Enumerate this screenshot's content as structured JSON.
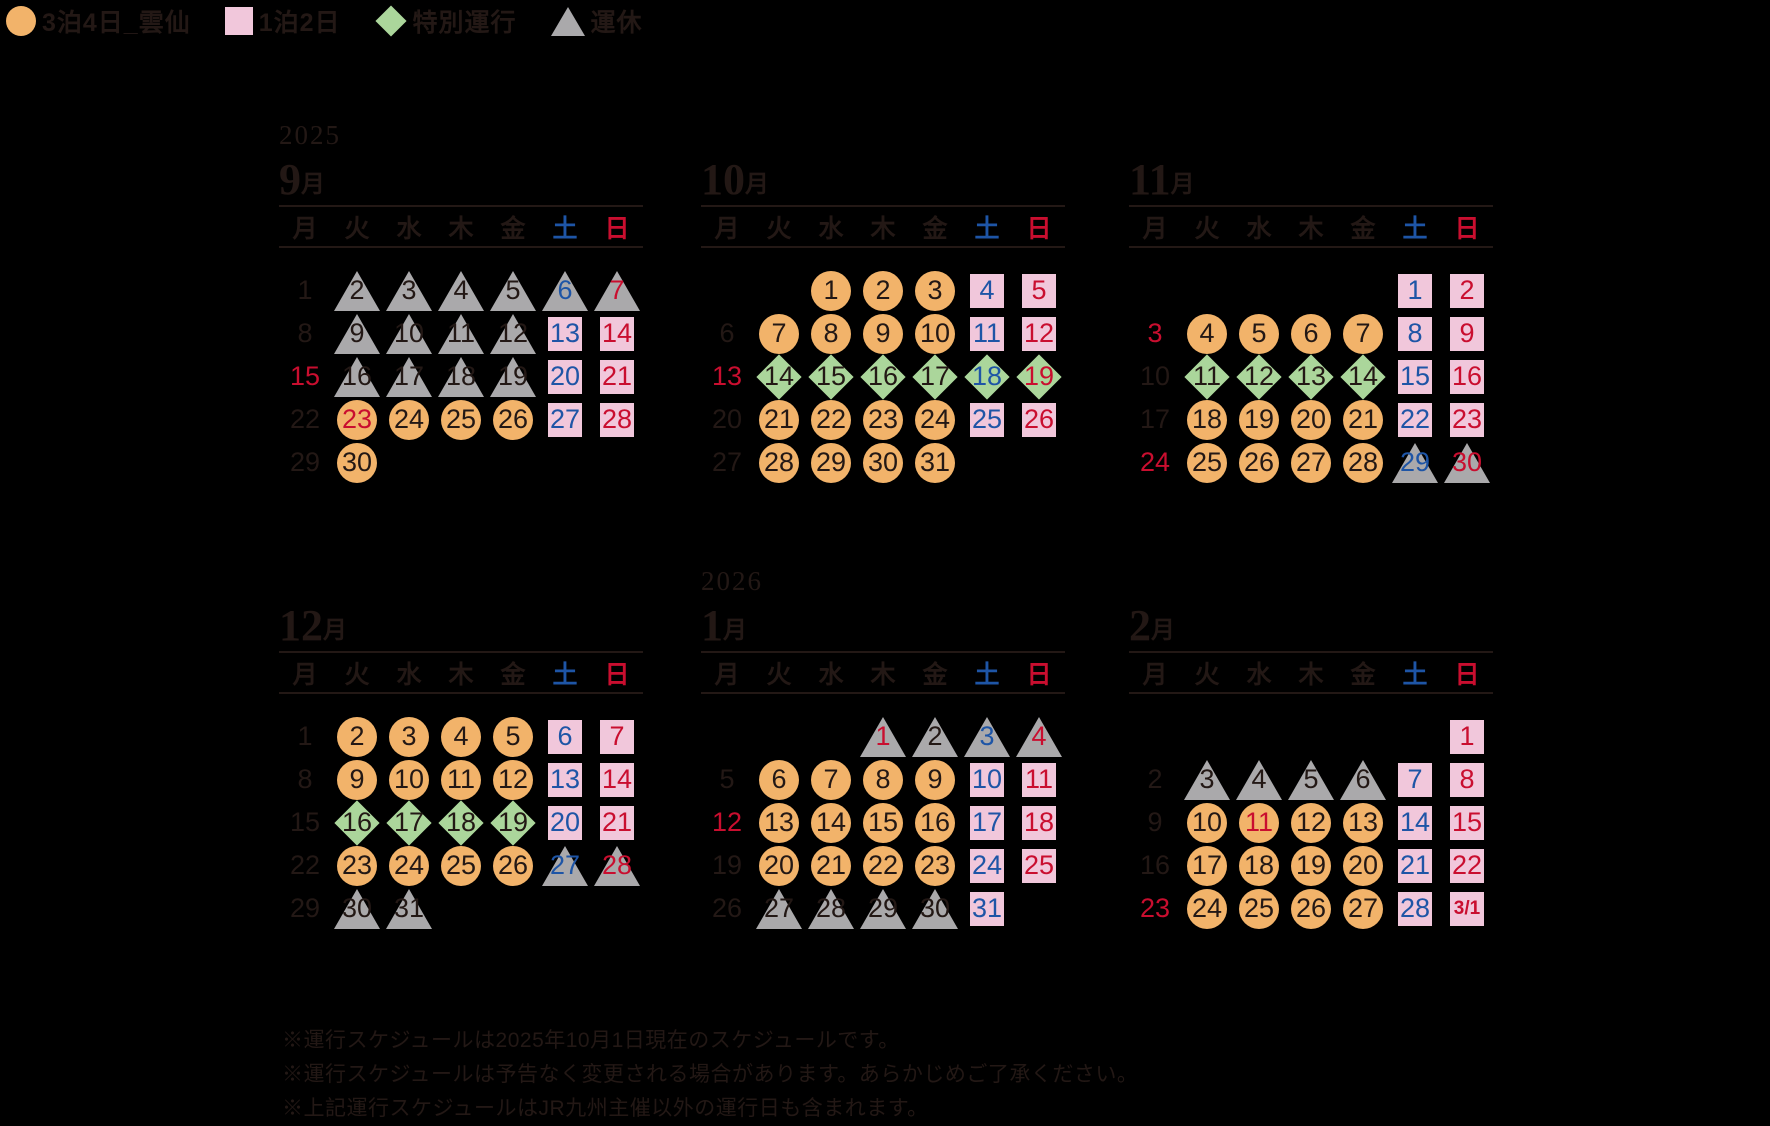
{
  "legend": {
    "items": [
      {
        "icon": "circle-icon",
        "shape": "circle",
        "label": "3泊4日_雲仙"
      },
      {
        "icon": "square-icon",
        "shape": "square",
        "label": "1泊2日"
      },
      {
        "icon": "diamond-icon",
        "shape": "diamond",
        "label": "特別運行"
      },
      {
        "icon": "triangle-icon",
        "shape": "triangle",
        "label": "運休"
      }
    ]
  },
  "colors": {
    "dark": "#231815",
    "saturday_blue": "#1e55a6",
    "sunday_red": "#c90e2f",
    "circle_orange": "#f2b36a",
    "square_pink": "#f1c7db",
    "diamond_green": "#abd69b",
    "triangle_gray": "#aaa9ab"
  },
  "weekdays": [
    {
      "label": "月",
      "color": "dark"
    },
    {
      "label": "火",
      "color": "dark"
    },
    {
      "label": "水",
      "color": "dark"
    },
    {
      "label": "木",
      "color": "dark"
    },
    {
      "label": "金",
      "color": "dark"
    },
    {
      "label": "土",
      "color": "blue"
    },
    {
      "label": "日",
      "color": "red"
    }
  ],
  "months": [
    {
      "year": "2025",
      "num": "9",
      "suffix": "月",
      "weeks": [
        [
          {
            "d": "1"
          },
          {
            "d": "2",
            "b": "triangle"
          },
          {
            "d": "3",
            "b": "triangle"
          },
          {
            "d": "4",
            "b": "triangle"
          },
          {
            "d": "5",
            "b": "triangle"
          },
          {
            "d": "6",
            "b": "triangle",
            "c": "blue"
          },
          {
            "d": "7",
            "b": "triangle",
            "c": "red"
          }
        ],
        [
          {
            "d": "8"
          },
          {
            "d": "9",
            "b": "triangle"
          },
          {
            "d": "10",
            "b": "triangle"
          },
          {
            "d": "11",
            "b": "triangle"
          },
          {
            "d": "12",
            "b": "triangle"
          },
          {
            "d": "13",
            "b": "square",
            "c": "blue"
          },
          {
            "d": "14",
            "b": "square",
            "c": "red"
          }
        ],
        [
          {
            "d": "15",
            "c": "red"
          },
          {
            "d": "16",
            "b": "triangle"
          },
          {
            "d": "17",
            "b": "triangle"
          },
          {
            "d": "18",
            "b": "triangle"
          },
          {
            "d": "19",
            "b": "triangle"
          },
          {
            "d": "20",
            "b": "square",
            "c": "blue"
          },
          {
            "d": "21",
            "b": "square",
            "c": "red"
          }
        ],
        [
          {
            "d": "22"
          },
          {
            "d": "23",
            "b": "circle",
            "c": "red"
          },
          {
            "d": "24",
            "b": "circle"
          },
          {
            "d": "25",
            "b": "circle"
          },
          {
            "d": "26",
            "b": "circle"
          },
          {
            "d": "27",
            "b": "square",
            "c": "blue"
          },
          {
            "d": "28",
            "b": "square",
            "c": "red"
          }
        ],
        [
          {
            "d": "29"
          },
          {
            "d": "30",
            "b": "circle"
          },
          null,
          null,
          null,
          null,
          null
        ]
      ]
    },
    {
      "year": "",
      "num": "10",
      "suffix": "月",
      "weeks": [
        [
          null,
          null,
          {
            "d": "1",
            "b": "circle"
          },
          {
            "d": "2",
            "b": "circle"
          },
          {
            "d": "3",
            "b": "circle"
          },
          {
            "d": "4",
            "b": "square",
            "c": "blue"
          },
          {
            "d": "5",
            "b": "square",
            "c": "red"
          }
        ],
        [
          {
            "d": "6"
          },
          {
            "d": "7",
            "b": "circle"
          },
          {
            "d": "8",
            "b": "circle"
          },
          {
            "d": "9",
            "b": "circle"
          },
          {
            "d": "10",
            "b": "circle"
          },
          {
            "d": "11",
            "b": "square",
            "c": "blue"
          },
          {
            "d": "12",
            "b": "square",
            "c": "red"
          }
        ],
        [
          {
            "d": "13",
            "c": "red"
          },
          {
            "d": "14",
            "b": "diamond"
          },
          {
            "d": "15",
            "b": "diamond"
          },
          {
            "d": "16",
            "b": "diamond"
          },
          {
            "d": "17",
            "b": "diamond"
          },
          {
            "d": "18",
            "b": "diamond",
            "c": "blue"
          },
          {
            "d": "19",
            "b": "diamond",
            "c": "red"
          }
        ],
        [
          {
            "d": "20"
          },
          {
            "d": "21",
            "b": "circle"
          },
          {
            "d": "22",
            "b": "circle"
          },
          {
            "d": "23",
            "b": "circle"
          },
          {
            "d": "24",
            "b": "circle"
          },
          {
            "d": "25",
            "b": "square",
            "c": "blue"
          },
          {
            "d": "26",
            "b": "square",
            "c": "red"
          }
        ],
        [
          {
            "d": "27"
          },
          {
            "d": "28",
            "b": "circle"
          },
          {
            "d": "29",
            "b": "circle"
          },
          {
            "d": "30",
            "b": "circle"
          },
          {
            "d": "31",
            "b": "circle"
          },
          null,
          null
        ]
      ]
    },
    {
      "year": "",
      "num": "11",
      "suffix": "月",
      "weeks": [
        [
          null,
          null,
          null,
          null,
          null,
          {
            "d": "1",
            "b": "square",
            "c": "blue"
          },
          {
            "d": "2",
            "b": "square",
            "c": "red"
          }
        ],
        [
          {
            "d": "3",
            "c": "red"
          },
          {
            "d": "4",
            "b": "circle"
          },
          {
            "d": "5",
            "b": "circle"
          },
          {
            "d": "6",
            "b": "circle"
          },
          {
            "d": "7",
            "b": "circle"
          },
          {
            "d": "8",
            "b": "square",
            "c": "blue"
          },
          {
            "d": "9",
            "b": "square",
            "c": "red"
          }
        ],
        [
          {
            "d": "10"
          },
          {
            "d": "11",
            "b": "diamond"
          },
          {
            "d": "12",
            "b": "diamond"
          },
          {
            "d": "13",
            "b": "diamond"
          },
          {
            "d": "14",
            "b": "diamond"
          },
          {
            "d": "15",
            "b": "square",
            "c": "blue"
          },
          {
            "d": "16",
            "b": "square",
            "c": "red"
          }
        ],
        [
          {
            "d": "17"
          },
          {
            "d": "18",
            "b": "circle"
          },
          {
            "d": "19",
            "b": "circle"
          },
          {
            "d": "20",
            "b": "circle"
          },
          {
            "d": "21",
            "b": "circle"
          },
          {
            "d": "22",
            "b": "square",
            "c": "blue"
          },
          {
            "d": "23",
            "b": "square",
            "c": "red"
          }
        ],
        [
          {
            "d": "24",
            "c": "red"
          },
          {
            "d": "25",
            "b": "circle"
          },
          {
            "d": "26",
            "b": "circle"
          },
          {
            "d": "27",
            "b": "circle"
          },
          {
            "d": "28",
            "b": "circle"
          },
          {
            "d": "29",
            "b": "triangle",
            "c": "blue"
          },
          {
            "d": "30",
            "b": "triangle",
            "c": "red"
          }
        ]
      ]
    },
    {
      "year": "",
      "num": "12",
      "suffix": "月",
      "weeks": [
        [
          {
            "d": "1"
          },
          {
            "d": "2",
            "b": "circle"
          },
          {
            "d": "3",
            "b": "circle"
          },
          {
            "d": "4",
            "b": "circle"
          },
          {
            "d": "5",
            "b": "circle"
          },
          {
            "d": "6",
            "b": "square",
            "c": "blue"
          },
          {
            "d": "7",
            "b": "square",
            "c": "red"
          }
        ],
        [
          {
            "d": "8"
          },
          {
            "d": "9",
            "b": "circle"
          },
          {
            "d": "10",
            "b": "circle"
          },
          {
            "d": "11",
            "b": "circle"
          },
          {
            "d": "12",
            "b": "circle"
          },
          {
            "d": "13",
            "b": "square",
            "c": "blue"
          },
          {
            "d": "14",
            "b": "square",
            "c": "red"
          }
        ],
        [
          {
            "d": "15"
          },
          {
            "d": "16",
            "b": "diamond"
          },
          {
            "d": "17",
            "b": "diamond"
          },
          {
            "d": "18",
            "b": "diamond"
          },
          {
            "d": "19",
            "b": "diamond"
          },
          {
            "d": "20",
            "b": "square",
            "c": "blue"
          },
          {
            "d": "21",
            "b": "square",
            "c": "red"
          }
        ],
        [
          {
            "d": "22"
          },
          {
            "d": "23",
            "b": "circle"
          },
          {
            "d": "24",
            "b": "circle"
          },
          {
            "d": "25",
            "b": "circle"
          },
          {
            "d": "26",
            "b": "circle"
          },
          {
            "d": "27",
            "b": "triangle",
            "c": "blue"
          },
          {
            "d": "28",
            "b": "triangle",
            "c": "red"
          }
        ],
        [
          {
            "d": "29"
          },
          {
            "d": "30",
            "b": "triangle"
          },
          {
            "d": "31",
            "b": "triangle"
          },
          null,
          null,
          null,
          null
        ]
      ]
    },
    {
      "year": "2026",
      "num": "1",
      "suffix": "月",
      "weeks": [
        [
          null,
          null,
          null,
          {
            "d": "1",
            "b": "triangle",
            "c": "red"
          },
          {
            "d": "2",
            "b": "triangle"
          },
          {
            "d": "3",
            "b": "triangle",
            "c": "blue"
          },
          {
            "d": "4",
            "b": "triangle",
            "c": "red"
          }
        ],
        [
          {
            "d": "5"
          },
          {
            "d": "6",
            "b": "circle"
          },
          {
            "d": "7",
            "b": "circle"
          },
          {
            "d": "8",
            "b": "circle"
          },
          {
            "d": "9",
            "b": "circle"
          },
          {
            "d": "10",
            "b": "square",
            "c": "blue"
          },
          {
            "d": "11",
            "b": "square",
            "c": "red"
          }
        ],
        [
          {
            "d": "12",
            "c": "red"
          },
          {
            "d": "13",
            "b": "circle"
          },
          {
            "d": "14",
            "b": "circle"
          },
          {
            "d": "15",
            "b": "circle"
          },
          {
            "d": "16",
            "b": "circle"
          },
          {
            "d": "17",
            "b": "square",
            "c": "blue"
          },
          {
            "d": "18",
            "b": "square",
            "c": "red"
          }
        ],
        [
          {
            "d": "19"
          },
          {
            "d": "20",
            "b": "circle"
          },
          {
            "d": "21",
            "b": "circle"
          },
          {
            "d": "22",
            "b": "circle"
          },
          {
            "d": "23",
            "b": "circle"
          },
          {
            "d": "24",
            "b": "square",
            "c": "blue"
          },
          {
            "d": "25",
            "b": "square",
            "c": "red"
          }
        ],
        [
          {
            "d": "26"
          },
          {
            "d": "27",
            "b": "triangle"
          },
          {
            "d": "28",
            "b": "triangle"
          },
          {
            "d": "29",
            "b": "triangle"
          },
          {
            "d": "30",
            "b": "triangle"
          },
          {
            "d": "31",
            "b": "square",
            "c": "blue"
          },
          null
        ]
      ]
    },
    {
      "year": "",
      "num": "2",
      "suffix": "月",
      "weeks": [
        [
          null,
          null,
          null,
          null,
          null,
          null,
          {
            "d": "1",
            "b": "square",
            "c": "red"
          }
        ],
        [
          {
            "d": "2"
          },
          {
            "d": "3",
            "b": "triangle"
          },
          {
            "d": "4",
            "b": "triangle"
          },
          {
            "d": "5",
            "b": "triangle"
          },
          {
            "d": "6",
            "b": "triangle"
          },
          {
            "d": "7",
            "b": "square",
            "c": "blue"
          },
          {
            "d": "8",
            "b": "square",
            "c": "red"
          }
        ],
        [
          {
            "d": "9"
          },
          {
            "d": "10",
            "b": "circle"
          },
          {
            "d": "11",
            "b": "circle",
            "c": "red"
          },
          {
            "d": "12",
            "b": "circle"
          },
          {
            "d": "13",
            "b": "circle"
          },
          {
            "d": "14",
            "b": "square",
            "c": "blue"
          },
          {
            "d": "15",
            "b": "square",
            "c": "red"
          }
        ],
        [
          {
            "d": "16"
          },
          {
            "d": "17",
            "b": "circle"
          },
          {
            "d": "18",
            "b": "circle"
          },
          {
            "d": "19",
            "b": "circle"
          },
          {
            "d": "20",
            "b": "circle"
          },
          {
            "d": "21",
            "b": "square",
            "c": "blue"
          },
          {
            "d": "22",
            "b": "square",
            "c": "red"
          }
        ],
        [
          {
            "d": "23",
            "c": "red"
          },
          {
            "d": "24",
            "b": "circle"
          },
          {
            "d": "25",
            "b": "circle"
          },
          {
            "d": "26",
            "b": "circle"
          },
          {
            "d": "27",
            "b": "circle"
          },
          {
            "d": "28",
            "b": "square",
            "c": "blue"
          },
          {
            "d": "3/1",
            "b": "square",
            "c": "red"
          }
        ]
      ]
    }
  ],
  "notes": [
    "※運行スケジュールは2025年10月1日現在のスケジュールです。",
    "※運行スケジュールは予告なく変更される場合があります。あらかじめご了承ください。",
    "※上記運行スケジュールはJR九州主催以外の運行日も含まれます。"
  ]
}
